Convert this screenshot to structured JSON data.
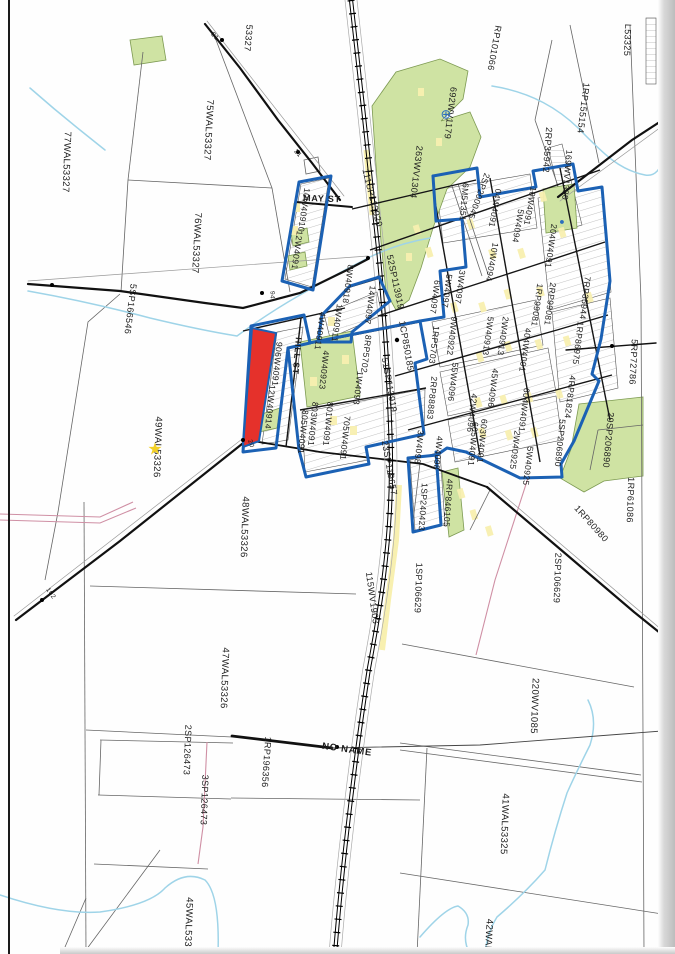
{
  "colors": {
    "blue": "#1b61b4",
    "red": "#e5312b",
    "green": "#cfe3a3",
    "greenline": "#7d9a52",
    "yellow": "#f8f0b0",
    "creek": "#9fd4e8",
    "pink": "#cf8fa4",
    "ink": "#1d1d1d",
    "line": "#666666"
  },
  "map": {
    "street_names": [
      "MAY ST",
      "HILL ST",
      "NO NAME"
    ],
    "labels": [
      {
        "t": "53327",
        "x": 248,
        "y": 38,
        "r": 95,
        "s": 9,
        "k": "parcel"
      },
      {
        "t": "75WAL53327",
        "x": 208,
        "y": 130,
        "r": 93,
        "s": 9.5,
        "k": "parcel"
      },
      {
        "t": "77WAL53327",
        "x": 66,
        "y": 162,
        "r": 92,
        "s": 9.5,
        "k": "parcel"
      },
      {
        "t": "76WAL53327",
        "x": 196,
        "y": 243,
        "r": 93,
        "s": 9.5,
        "k": "parcel"
      },
      {
        "t": "5SP166546",
        "x": 130,
        "y": 309,
        "r": 97,
        "s": 9,
        "k": "parcel"
      },
      {
        "t": "49WAL53326",
        "x": 157,
        "y": 447,
        "r": 92,
        "s": 9.5,
        "k": "parcel"
      },
      {
        "t": "48WAL53326",
        "x": 244,
        "y": 527,
        "r": 92,
        "s": 9.5,
        "k": "parcel"
      },
      {
        "t": "47WAL53326",
        "x": 224,
        "y": 678,
        "r": 92,
        "s": 9.5,
        "k": "parcel"
      },
      {
        "t": "45WAL5332",
        "x": 188,
        "y": 925,
        "r": 92,
        "s": 9.5,
        "k": "parcel"
      },
      {
        "t": "2SP126473",
        "x": 187,
        "y": 750,
        "r": 92,
        "s": 9,
        "k": "parcel"
      },
      {
        "t": "3SP126473",
        "x": 204,
        "y": 800,
        "r": 92,
        "s": 9,
        "k": "parcel"
      },
      {
        "t": "1RP196356",
        "x": 266,
        "y": 762,
        "r": 94,
        "s": 9,
        "k": "parcel"
      },
      {
        "t": "NO NAME",
        "x": 347,
        "y": 750,
        "r": 8,
        "s": 9.5,
        "b": true,
        "k": "street"
      },
      {
        "t": "41WAL53325",
        "x": 504,
        "y": 824,
        "r": 92,
        "s": 9.5,
        "k": "parcel"
      },
      {
        "t": "220WV1085",
        "x": 534,
        "y": 706,
        "r": 92,
        "s": 9.5,
        "k": "parcel"
      },
      {
        "t": "42WAL5",
        "x": 488,
        "y": 938,
        "r": 93,
        "s": 9.5,
        "k": "parcel"
      },
      {
        "t": "2SP106629",
        "x": 557,
        "y": 578,
        "r": 92,
        "s": 9,
        "k": "parcel"
      },
      {
        "t": "1SP106629",
        "x": 418,
        "y": 588,
        "r": 92,
        "s": 9,
        "k": "parcel"
      },
      {
        "t": "1RP61086",
        "x": 630,
        "y": 500,
        "r": 92,
        "s": 9,
        "k": "parcel"
      },
      {
        "t": "1RP80980",
        "x": 591,
        "y": 524,
        "r": 48,
        "s": 9,
        "k": "parcel"
      },
      {
        "t": "29SP206890",
        "x": 608,
        "y": 440,
        "r": 95,
        "s": 9,
        "k": "parcel"
      },
      {
        "t": "5RP72786",
        "x": 633,
        "y": 362,
        "r": 93,
        "s": 9,
        "k": "parcel"
      },
      {
        "t": "RP101066",
        "x": 494,
        "y": 48,
        "r": 100,
        "s": 9,
        "k": "parcel"
      },
      {
        "t": "1RP155154",
        "x": 583,
        "y": 108,
        "r": 97,
        "s": 9,
        "k": "parcel"
      },
      {
        "t": "2RP35942",
        "x": 547,
        "y": 150,
        "r": 94,
        "s": 9,
        "k": "parcel"
      },
      {
        "t": "169WV1380",
        "x": 567,
        "y": 175,
        "r": 95,
        "s": 8.5,
        "k": "parcel"
      },
      {
        "t": "L53325",
        "x": 627,
        "y": 40,
        "r": 92,
        "s": 9,
        "k": "parcel"
      },
      {
        "t": "692WV1179",
        "x": 450,
        "y": 113,
        "r": 97,
        "s": 9,
        "k": "parcel"
      },
      {
        "t": "263WV1304",
        "x": 416,
        "y": 172,
        "r": 97,
        "s": 9,
        "k": "parcel"
      },
      {
        "t": "6M51351",
        "x": 464,
        "y": 202,
        "r": 95,
        "s": 8.5,
        "k": "parcel"
      },
      {
        "t": "2SP200045",
        "x": 479,
        "y": 196,
        "r": 110,
        "s": 8.5,
        "k": "parcel"
      },
      {
        "t": "111SP113920",
        "x": 372,
        "y": 198,
        "r": 76,
        "s": 9,
        "k": "plan"
      },
      {
        "t": "52SP113919",
        "x": 395,
        "y": 282,
        "r": 78,
        "s": 9,
        "k": "plan"
      },
      {
        "t": "51SP113919",
        "x": 389,
        "y": 385,
        "r": 80,
        "s": 9,
        "k": "plan"
      },
      {
        "t": "1CP850185",
        "x": 406,
        "y": 346,
        "r": 80,
        "s": 9,
        "k": "plan"
      },
      {
        "t": "23SP119657",
        "x": 389,
        "y": 468,
        "r": 80,
        "s": 9,
        "k": "plan"
      },
      {
        "t": "115WV1903",
        "x": 372,
        "y": 598,
        "r": 82,
        "s": 9,
        "k": "plan"
      },
      {
        "t": "MAY ST",
        "x": 322,
        "y": 199,
        "r": 2,
        "s": 9,
        "b": true,
        "k": "street"
      },
      {
        "t": "HILL ST",
        "x": 297,
        "y": 356,
        "r": 95,
        "s": 8.5,
        "b": true,
        "k": "street"
      },
      {
        "t": "10W40910",
        "x": 304,
        "y": 210,
        "r": 98,
        "s": 8.5,
        "k": "lot"
      },
      {
        "t": "12W4091",
        "x": 297,
        "y": 250,
        "r": 98,
        "s": 8.5,
        "k": "lot"
      },
      {
        "t": "8W40918",
        "x": 348,
        "y": 284,
        "r": 98,
        "s": 8.5,
        "k": "lot"
      },
      {
        "t": "14W4097",
        "x": 370,
        "y": 305,
        "r": 98,
        "s": 8.5,
        "k": "lot"
      },
      {
        "t": "1W40911",
        "x": 337,
        "y": 323,
        "r": 98,
        "s": 8.5,
        "k": "lot"
      },
      {
        "t": "4W40911",
        "x": 320,
        "y": 331,
        "r": 98,
        "s": 8.5,
        "k": "lot"
      },
      {
        "t": "906W4091",
        "x": 277,
        "y": 364,
        "r": 96,
        "s": 8.5,
        "k": "lot"
      },
      {
        "t": "12W40914",
        "x": 270,
        "y": 407,
        "r": 96,
        "s": 8.5,
        "k": "lot"
      },
      {
        "t": "4W40923",
        "x": 324,
        "y": 370,
        "r": 96,
        "s": 8.5,
        "k": "lot"
      },
      {
        "t": "8RP5702",
        "x": 366,
        "y": 354,
        "r": 97,
        "s": 8.5,
        "k": "lot"
      },
      {
        "t": "1W4093",
        "x": 358,
        "y": 388,
        "r": 97,
        "s": 8.5,
        "k": "lot"
      },
      {
        "t": "801W4091",
        "x": 328,
        "y": 424,
        "r": 96,
        "s": 8.5,
        "k": "lot"
      },
      {
        "t": "803W4091",
        "x": 313,
        "y": 424,
        "r": 96,
        "s": 8.5,
        "k": "lot"
      },
      {
        "t": "805W4091",
        "x": 303,
        "y": 432,
        "r": 96,
        "s": 8.5,
        "k": "lot"
      },
      {
        "t": "705W4091",
        "x": 345,
        "y": 438,
        "r": 96,
        "s": 8.5,
        "k": "lot"
      },
      {
        "t": "04W4091",
        "x": 495,
        "y": 208,
        "r": 100,
        "s": 8.5,
        "k": "lot"
      },
      {
        "t": "5W4094",
        "x": 518,
        "y": 226,
        "r": 100,
        "s": 8.5,
        "k": "lot"
      },
      {
        "t": "10W4091",
        "x": 530,
        "y": 206,
        "r": 100,
        "s": 8.5,
        "k": "lot"
      },
      {
        "t": "10W4094",
        "x": 492,
        "y": 262,
        "r": 100,
        "s": 8.5,
        "k": "lot"
      },
      {
        "t": "204W4091",
        "x": 551,
        "y": 246,
        "r": 98,
        "s": 8.5,
        "k": "lot"
      },
      {
        "t": "7RP35944",
        "x": 585,
        "y": 298,
        "r": 97,
        "s": 8.5,
        "k": "lot"
      },
      {
        "t": "1RP99081",
        "x": 537,
        "y": 305,
        "r": 98,
        "s": 8.5,
        "k": "lot"
      },
      {
        "t": "2RP99081",
        "x": 550,
        "y": 304,
        "r": 98,
        "s": 8.5,
        "k": "lot"
      },
      {
        "t": "404W4091",
        "x": 525,
        "y": 350,
        "r": 98,
        "s": 8.5,
        "k": "lot"
      },
      {
        "t": "1RP86975",
        "x": 578,
        "y": 343,
        "r": 97,
        "s": 8.5,
        "k": "lot"
      },
      {
        "t": "4RP81824",
        "x": 570,
        "y": 397,
        "r": 97,
        "s": 8.5,
        "k": "lot"
      },
      {
        "t": "5SP206890",
        "x": 560,
        "y": 443,
        "r": 96,
        "s": 8.5,
        "k": "lot"
      },
      {
        "t": "3W4097",
        "x": 460,
        "y": 287,
        "r": 98,
        "s": 8.5,
        "k": "lot"
      },
      {
        "t": "5W4097",
        "x": 447,
        "y": 291,
        "r": 98,
        "s": 8.5,
        "k": "lot"
      },
      {
        "t": "6W4097",
        "x": 435,
        "y": 297,
        "r": 98,
        "s": 8.5,
        "k": "lot"
      },
      {
        "t": "1RP5703",
        "x": 434,
        "y": 345,
        "r": 97,
        "s": 8.5,
        "k": "lot"
      },
      {
        "t": "9W40922",
        "x": 452,
        "y": 336,
        "r": 97,
        "s": 8.5,
        "k": "lot"
      },
      {
        "t": "5W40913",
        "x": 488,
        "y": 336,
        "r": 98,
        "s": 8.5,
        "k": "lot"
      },
      {
        "t": "2W40913",
        "x": 503,
        "y": 336,
        "r": 98,
        "s": 8.5,
        "k": "lot"
      },
      {
        "t": "45W4096",
        "x": 493,
        "y": 388,
        "r": 97,
        "s": 8.5,
        "k": "lot"
      },
      {
        "t": "42W4096",
        "x": 472,
        "y": 413,
        "r": 97,
        "s": 8.5,
        "k": "lot"
      },
      {
        "t": "55W4096",
        "x": 453,
        "y": 382,
        "r": 97,
        "s": 8.5,
        "k": "lot"
      },
      {
        "t": "2RP88883",
        "x": 432,
        "y": 398,
        "r": 96,
        "s": 8.5,
        "k": "lot"
      },
      {
        "t": "604W4091",
        "x": 524,
        "y": 410,
        "r": 97,
        "s": 8.5,
        "k": "lot"
      },
      {
        "t": "603W4091",
        "x": 482,
        "y": 441,
        "r": 96,
        "s": 8.5,
        "k": "lot"
      },
      {
        "t": "605W4091",
        "x": 473,
        "y": 444,
        "r": 96,
        "s": 8.5,
        "k": "lot"
      },
      {
        "t": "2W40925",
        "x": 515,
        "y": 450,
        "r": 97,
        "s": 8.5,
        "k": "lot"
      },
      {
        "t": "5W40925",
        "x": 528,
        "y": 466,
        "r": 97,
        "s": 8.5,
        "k": "lot"
      },
      {
        "t": "4W4098",
        "x": 438,
        "y": 453,
        "r": 96,
        "s": 8.5,
        "k": "lot"
      },
      {
        "t": "3W4098",
        "x": 419,
        "y": 447,
        "r": 96,
        "s": 8.5,
        "k": "lot"
      },
      {
        "t": "1SP240423",
        "x": 423,
        "y": 507,
        "r": 94,
        "s": 8.5,
        "k": "lot"
      },
      {
        "t": "4RP846105",
        "x": 448,
        "y": 503,
        "r": 94,
        "s": 8.5,
        "k": "lot"
      },
      {
        "t": "21",
        "x": 214,
        "y": 37,
        "r": 48,
        "s": 6.5,
        "k": "road-number"
      },
      {
        "t": "21",
        "x": 297,
        "y": 154,
        "r": 48,
        "s": 6.5,
        "k": "road-number"
      },
      {
        "t": "94",
        "x": 271,
        "y": 295,
        "r": 90,
        "s": 6.5,
        "k": "road-number"
      },
      {
        "t": "20",
        "x": 250,
        "y": 444,
        "r": 72,
        "s": 6.5,
        "k": "road-number"
      },
      {
        "t": "102",
        "x": 50,
        "y": 594,
        "r": 55,
        "s": 6.5,
        "k": "road-number"
      }
    ],
    "markers": [
      {
        "name": "star-marker",
        "glyph": "★",
        "x": 155,
        "y": 449,
        "size": 17,
        "color": "#f2d027"
      },
      {
        "name": "survey-circle-marker",
        "glyph": "⊕",
        "x": 446,
        "y": 114,
        "size": 13,
        "color": "#2b6fbe"
      },
      {
        "name": "water-point-marker",
        "glyph": "●",
        "x": 562,
        "y": 222,
        "size": 9,
        "color": "#2b6fbe"
      }
    ]
  }
}
